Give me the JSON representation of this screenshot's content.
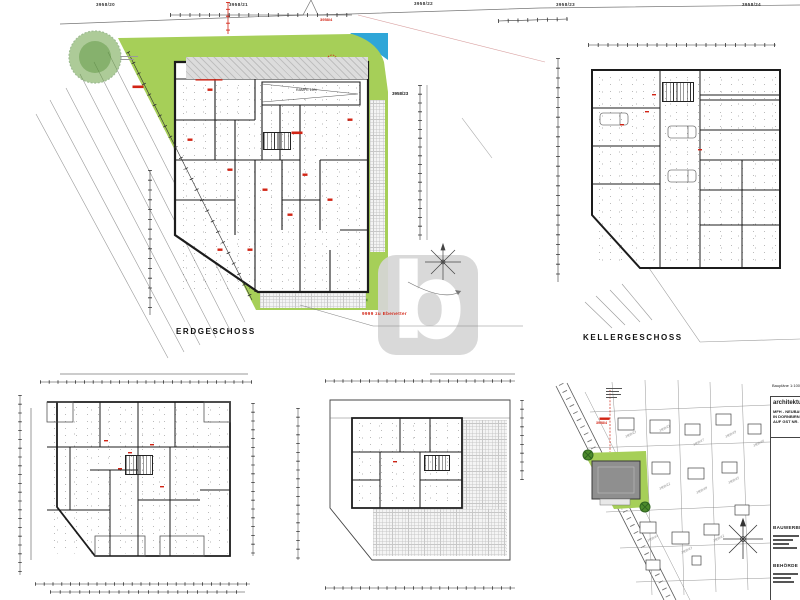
{
  "sheet": {
    "background": "#ffffff"
  },
  "colors": {
    "lawn_green": "#a6cf58",
    "tree_green": "#3f7a28",
    "water_blue": "#2fa6d8",
    "annotation_red": "#d22415",
    "wall_dark": "#1c1c1c",
    "paving_gray": "#dcdcdc",
    "watermark_gray": "#d6d6d6"
  },
  "watermark": {
    "letter": "b"
  },
  "site_boundary_labels": [
    "3958/20",
    "3958/21",
    "3958/22",
    "3958/23",
    "3958/24"
  ],
  "plans": {
    "erdgeschoss": {
      "title": "ERDGESCHOSS",
      "parcel_label": "3958/23",
      "ramp_label": "RAMPE 15%",
      "red_note": "9999 zu Ebenetter",
      "red_parcel": "3958/4"
    },
    "kellergeschoss": {
      "title": "KELLERGESCHOSS"
    },
    "lageplan": {
      "site_parcel_red": "3958/4",
      "parcel_numbers": [
        "3958/23",
        "3958/21",
        "3958/17",
        "3958/19",
        "3958/16",
        "3958/22",
        "3958/18",
        "3958/15",
        "3958/14",
        "3958/13",
        "3958/12"
      ]
    }
  },
  "title_block": {
    "scale_note": "Baupläne 1:100",
    "firm": "architektur",
    "project_lines": [
      "MFH - NEUBAU",
      "IN DORNBIRN",
      "AUF GST NR."
    ],
    "sections": [
      {
        "heading": "BAUWERBER"
      },
      {
        "heading": "BEHÖRDE"
      }
    ]
  }
}
